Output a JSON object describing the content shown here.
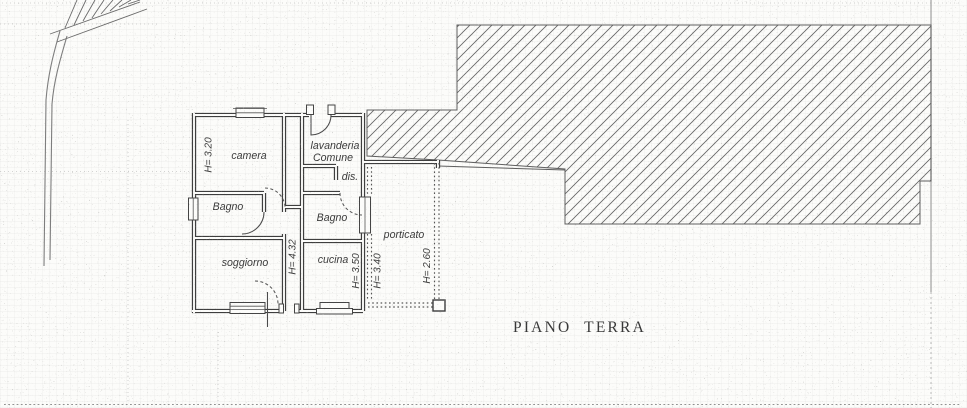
{
  "title": "PIANO TERRA",
  "plan": {
    "room_labels": {
      "camera": "camera",
      "lavanderia_line1": "lavanderia",
      "lavanderia_line2": "Comune",
      "dis": "dis.",
      "bagno_left": "Bagno",
      "bagno_right": "Bagno",
      "soggiorno": "soggiorno",
      "cucina": "cucina",
      "porticato": "porticato"
    },
    "height_labels": {
      "camera": "H= 3.20",
      "ingresso": "H= 4.32",
      "cucina": "H= 3.50",
      "bagno_right": "H= 3.40",
      "porticato": "H= 2.60"
    }
  },
  "colors": {
    "ink": "#3e3e3e",
    "paper": "#fcfcfa",
    "hatch_line": "#666666"
  }
}
